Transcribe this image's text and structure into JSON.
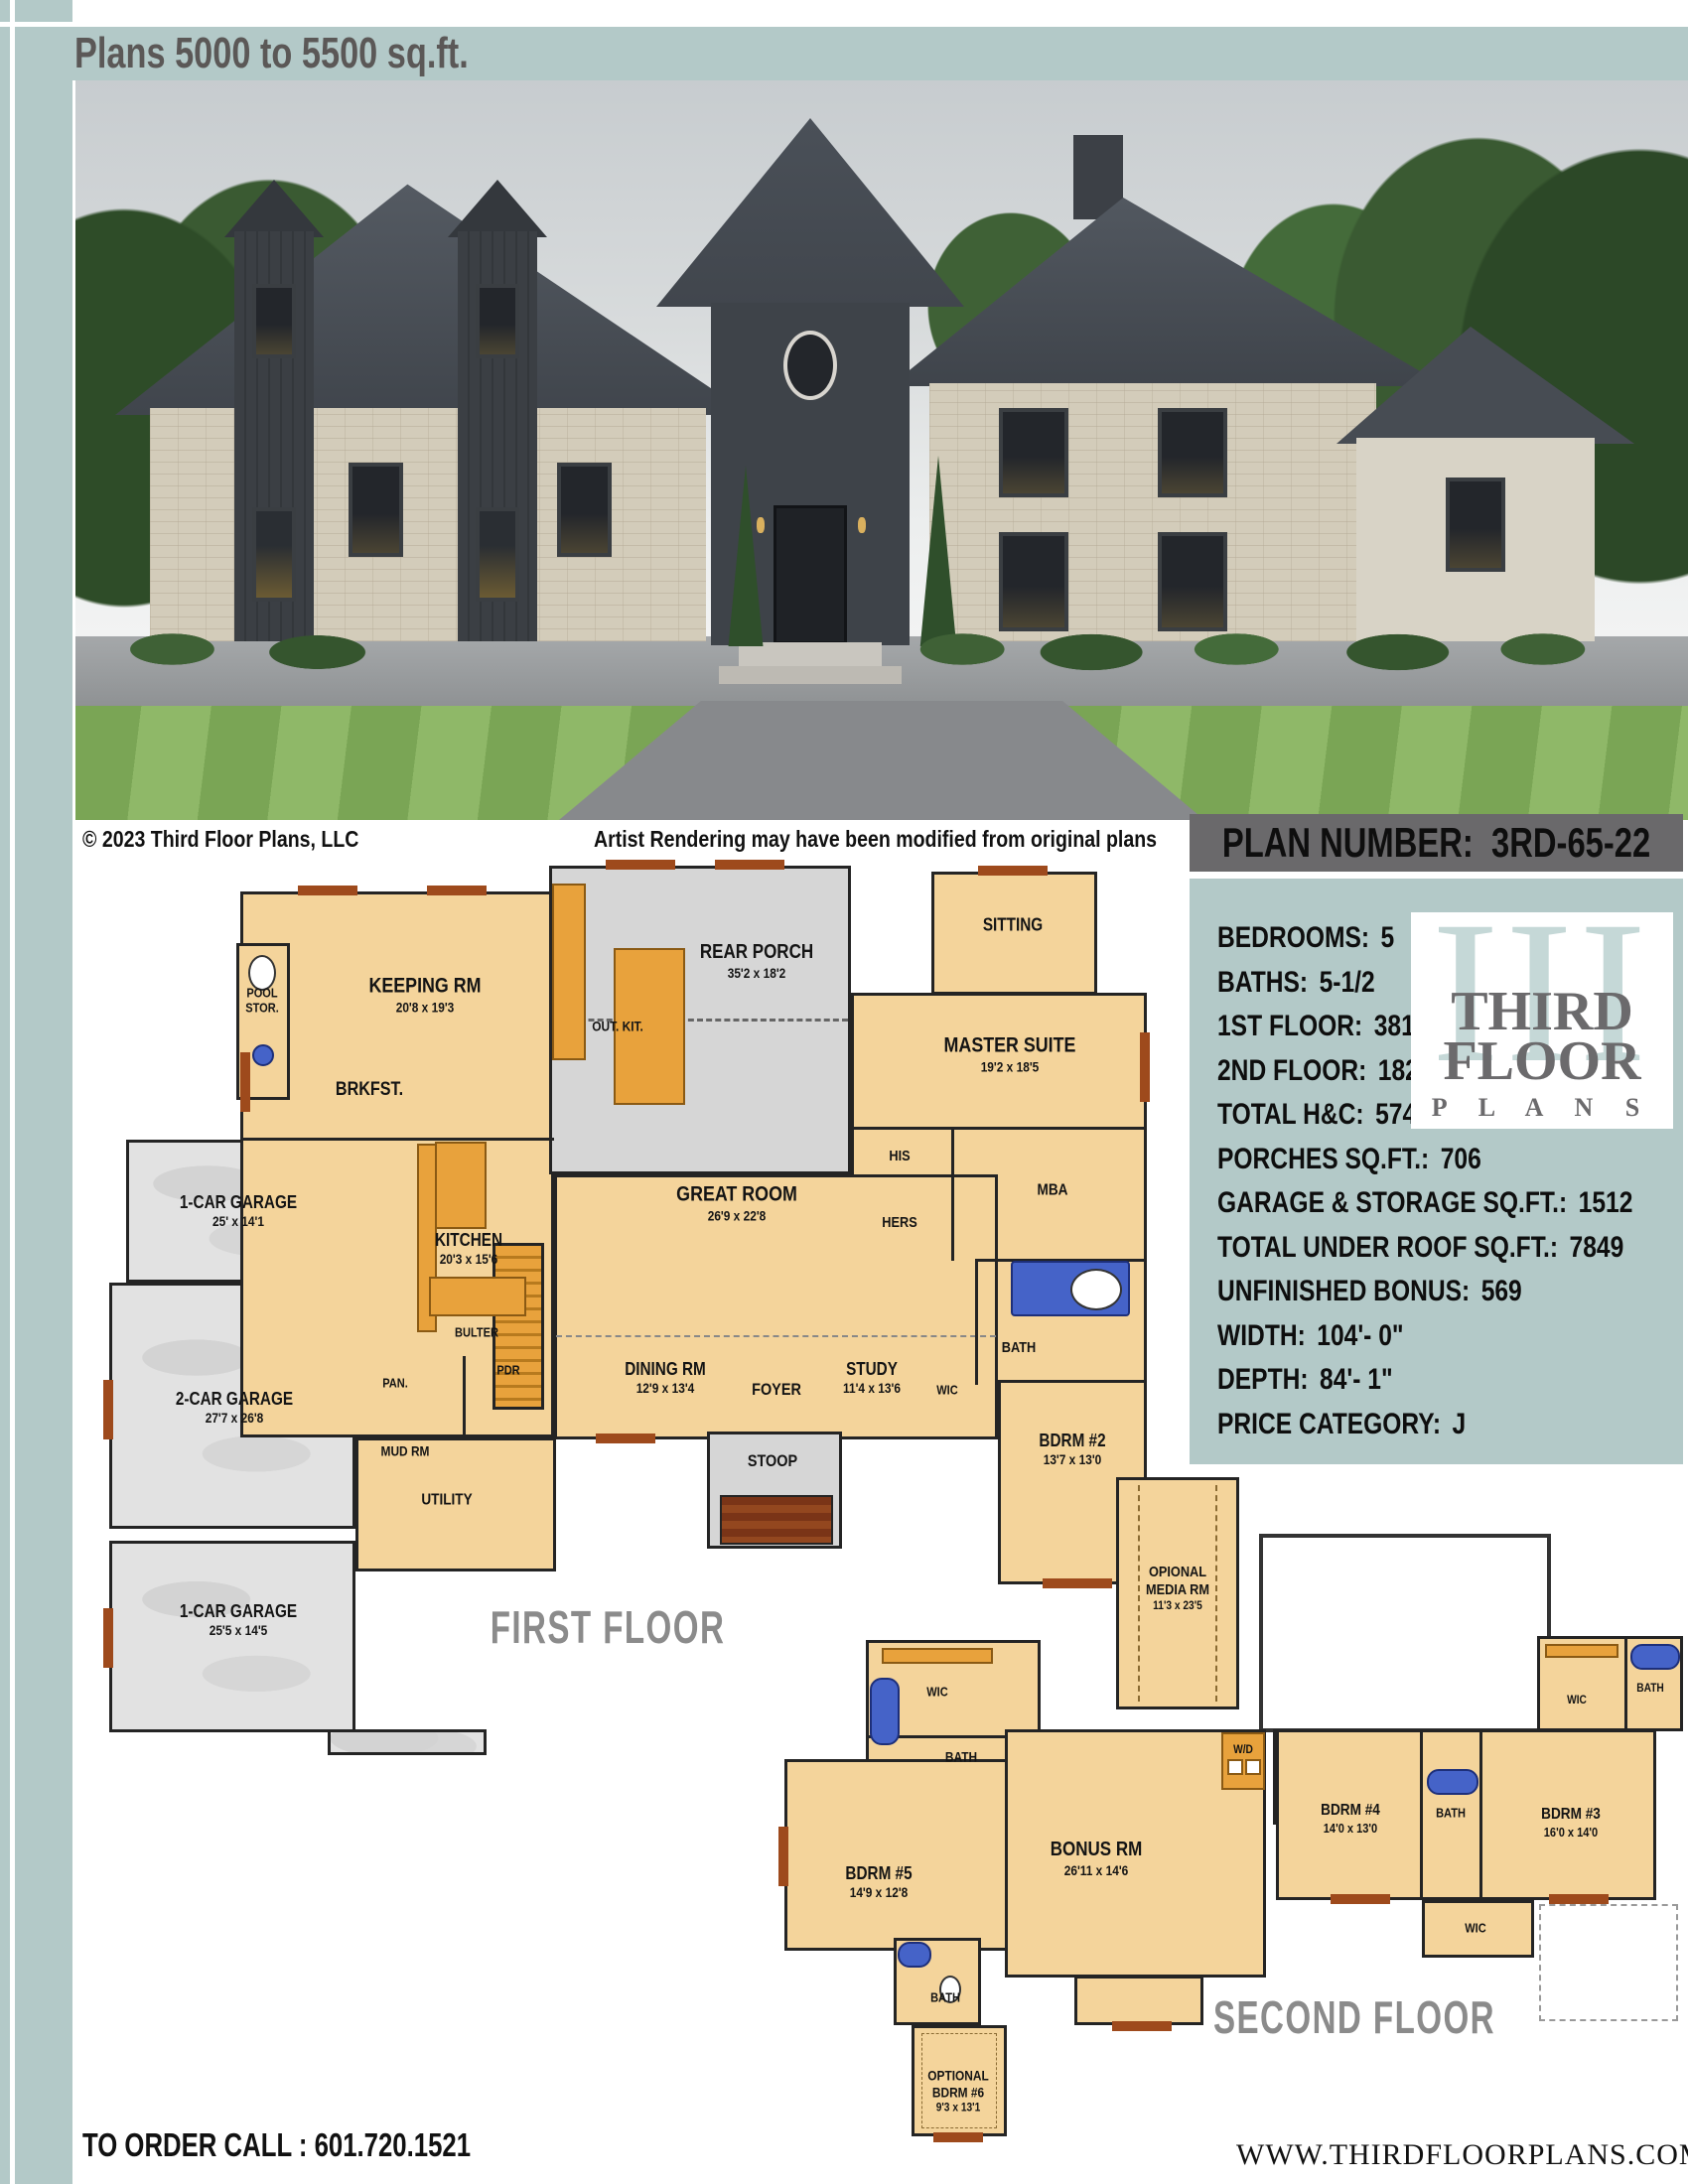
{
  "page": {
    "header_title": "Plans 5000 to 5500 sq.ft.",
    "copyright": "© 2023 Third Floor Plans, LLC",
    "rendering_note": "Artist Rendering may have been modified from original plans",
    "order_call": "TO ORDER CALL :  601.720.1521",
    "website": "WWW.THIRDFLOORPLANS.COM",
    "colors": {
      "teal": "#b3c9c8",
      "plan_box_gray": "#6a696b",
      "room_tan": "#f4d49b",
      "accent_orange": "#e8a23c",
      "fixture_blue": "#4563c8",
      "porch_gray": "#d6d6d6",
      "wall": "#242424"
    }
  },
  "plan_number": {
    "label": "PLAN NUMBER:",
    "value": "3RD-65-22"
  },
  "logo": {
    "numeral": "III",
    "word1": "THIRD",
    "word2": "FLOOR",
    "word3": "P L A N S"
  },
  "specs": [
    {
      "label": "BEDROOMS:",
      "value": "5"
    },
    {
      "label": "BATHS:",
      "value": "5-1/2"
    },
    {
      "label": "1ST FLOOR:",
      "value": "3810"
    },
    {
      "label": "2ND FLOOR:",
      "value": "1821"
    },
    {
      "label": "TOTAL H&C:",
      "value": "5745"
    },
    {
      "label": "PORCHES SQ.FT.:",
      "value": "706"
    },
    {
      "label": "GARAGE & STORAGE SQ.FT.:",
      "value": "1512"
    },
    {
      "label": "TOTAL UNDER ROOF SQ.FT.:",
      "value": "7849"
    },
    {
      "label": "UNFINISHED BONUS:",
      "value": "569"
    },
    {
      "label": "WIDTH:",
      "value": "104'- 0\""
    },
    {
      "label": "DEPTH:",
      "value": "84'- 1\""
    },
    {
      "label": "PRICE CATEGORY:",
      "value": "J"
    }
  ],
  "first_floor": {
    "title": "FIRST FLOOR",
    "rooms": {
      "pool": {
        "line1": "POOL",
        "line2": "STOR."
      },
      "keeping": {
        "name": "KEEPING RM",
        "dims": "20'8 x 19'3"
      },
      "brkfst": {
        "name": "BRKFST."
      },
      "out_kit": {
        "name": "OUT. KIT."
      },
      "rear_porch": {
        "name": "REAR PORCH",
        "dims": "35'2 x 18'2"
      },
      "sitting": {
        "name": "SITTING"
      },
      "master": {
        "name": "MASTER SUITE",
        "dims": "19'2 x 18'5"
      },
      "his": {
        "name": "HIS"
      },
      "hers": {
        "name": "HERS"
      },
      "mba": {
        "name": "MBA"
      },
      "bath": {
        "name": "BATH"
      },
      "wic": {
        "name": "WIC"
      },
      "bdrm2": {
        "name": "BDRM #2",
        "dims": "13'7 x 13'0"
      },
      "study": {
        "name": "STUDY",
        "dims": "11'4 x 13'6"
      },
      "dining": {
        "name": "DINING RM",
        "dims": "12'9 x 13'4"
      },
      "foyer": {
        "name": "FOYER"
      },
      "stoop": {
        "name": "STOOP"
      },
      "pan": {
        "name": "PAN."
      },
      "pdr": {
        "name": "PDR"
      },
      "mud": {
        "name": "MUD RM"
      },
      "utility": {
        "name": "UTILITY"
      },
      "kitchen": {
        "name": "KITCHEN",
        "dims": "20'3 x 15'6"
      },
      "butler": {
        "name": "BULTER"
      },
      "great": {
        "name": "GREAT ROOM",
        "dims": "26'9 x 22'8"
      },
      "garage_1": {
        "name": "1-CAR GARAGE",
        "dims": "25' x 14'1"
      },
      "garage_2": {
        "name": "2-CAR GARAGE",
        "dims": "27'7 x 26'8"
      },
      "garage_3": {
        "name": "1-CAR GARAGE",
        "dims": "25'5 x 14'5"
      }
    }
  },
  "second_floor": {
    "title": "SECOND FLOOR",
    "rooms": {
      "media": {
        "line1": "OPIONAL",
        "line2": "MEDIA RM",
        "dims": "11'3 x 23'5"
      },
      "wic_left": {
        "name": "WIC"
      },
      "bath_left": {
        "name": "BATH"
      },
      "bdrm5": {
        "name": "BDRM #5",
        "dims": "14'9 x 12'8"
      },
      "bonus": {
        "name": "BONUS RM",
        "dims": "26'11 x 14'6"
      },
      "wd": {
        "name": "W/D"
      },
      "bdrm4": {
        "name": "BDRM #4",
        "dims": "14'0 x 13'0"
      },
      "bath_mid": {
        "name": "BATH"
      },
      "bdrm3": {
        "name": "BDRM #3",
        "dims": "16'0 x 14'0"
      },
      "wic_top": {
        "name": "WIC"
      },
      "bath_top_right": {
        "name": "BATH"
      },
      "wic_bottom": {
        "name": "WIC"
      },
      "bath6": {
        "name": "BATH"
      },
      "bdrm6": {
        "line1": "OPTIONAL",
        "line2": "BDRM #6",
        "dims": "9'3 x 13'1"
      }
    }
  }
}
